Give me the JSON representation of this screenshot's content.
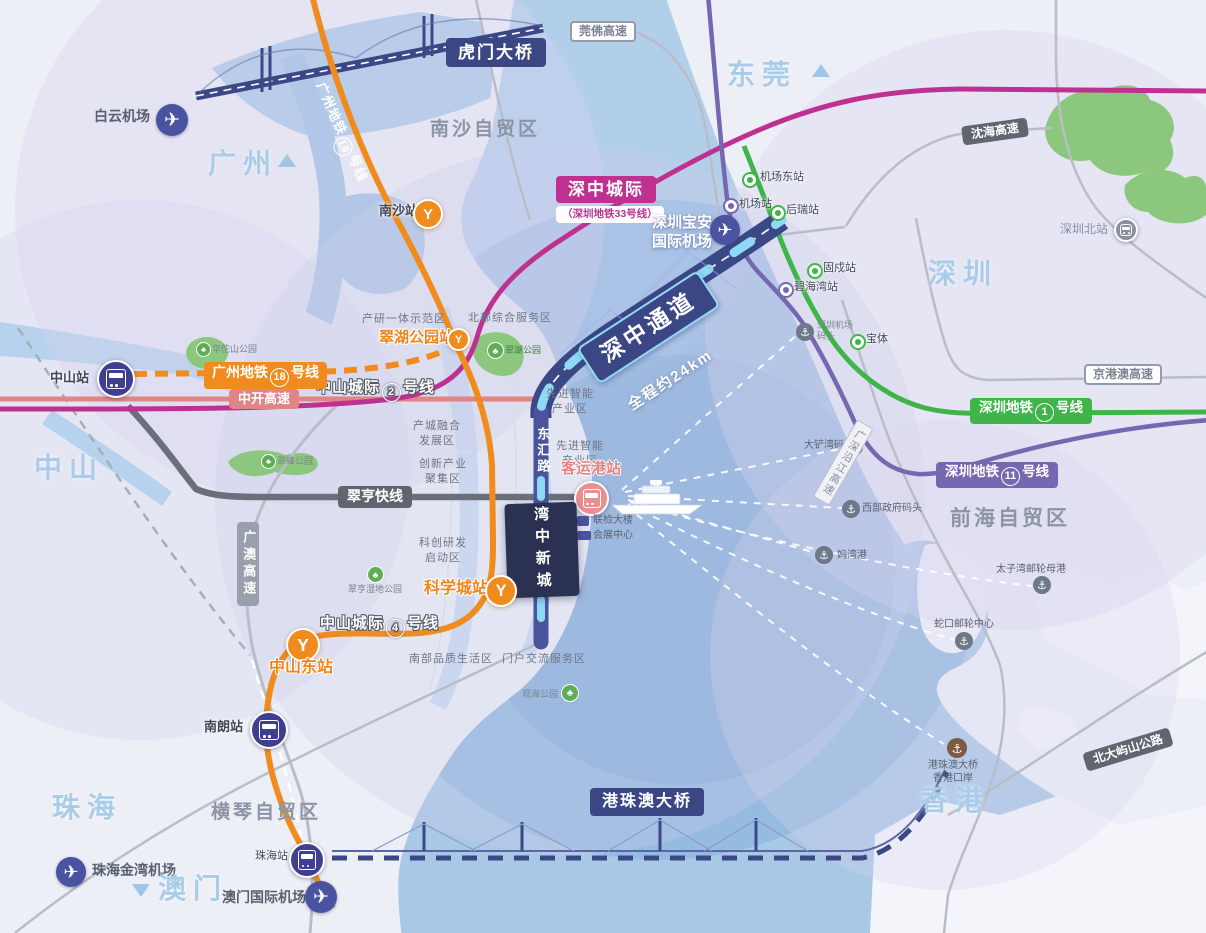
{
  "colors": {
    "orange": "#f08c1e",
    "magenta": "#bf3191",
    "navy": "#3a4784",
    "green": "#3fb44b",
    "purple": "#7668b0",
    "salmon": "#e08585",
    "coral": "#e89090",
    "dark_gray": "#60656f",
    "city_blue": "#a9cde9",
    "water": "#a9c8e6",
    "corridor_border": "#93d9f6",
    "park_green": "#8bc77d"
  },
  "cities": {
    "guangzhou": "广州",
    "dongguan": "东莞",
    "shenzhen": "深圳",
    "zhongshan": "中山",
    "zhuhai": "珠海",
    "macau": "澳门",
    "hongkong": "香港"
  },
  "zones": {
    "nansha": "南沙自贸区",
    "qianhai": "前海自贸区",
    "hengqin": "横琴自贸区"
  },
  "transit": {
    "gz18_prefix": "广州地铁",
    "gz18_num": "18",
    "gz18_suffix": "号线",
    "zs2_prefix": "中山城际",
    "zs2_num": "2",
    "zs2_suffix": "号线",
    "zs4_prefix": "中山城际",
    "zs4_num": "4",
    "zs4_suffix": "号线",
    "sz1_prefix": "深圳地铁",
    "sz1_num": "1",
    "sz1_suffix": "号线",
    "sz11_prefix": "深圳地铁",
    "sz11_num": "11",
    "sz11_suffix": "号线",
    "shenzhong_intercity": "深中城际",
    "shenzhong_intercity_sub": "（深圳地铁33号线）",
    "shenzhong_corridor": "深中通道",
    "corridor_length": "全程约24km",
    "cuiheng_express": "翠亨快线"
  },
  "roads": {
    "guanfo": "莞佛高速",
    "shenhai": "沈海高速",
    "zhongkai": "中开高速",
    "guangao": "广澳高速",
    "jinggangao": "京港澳高速",
    "yanjiang": "广深沿江高速",
    "north_lantau": "北大屿山公路",
    "donghui": "东汇路"
  },
  "bridges": {
    "humen": "虎门大桥",
    "hzmb": "港珠澳大桥"
  },
  "stations": {
    "nansha": "南沙站",
    "cuihu_park": "翠湖公园站",
    "zhongshan": "中山站",
    "science_city": "科学城站",
    "zhongshan_east": "中山东站",
    "nanlang": "南朗站",
    "zhuhai": "珠海站",
    "passenger_port": "客运港站",
    "shenzhen_north": "深圳北站",
    "airport_east": "机场东站",
    "airport": "机场站",
    "hourui": "后瑞站",
    "gushu": "固戍站",
    "bihaiwan": "碧海湾站",
    "baoti": "宝体"
  },
  "airports": {
    "baiyun": "白云机场",
    "szbaoan_line1": "深圳宝安",
    "szbaoan_line2": "国际机场",
    "zhuhai_jinwan": "珠海金湾机场",
    "macau_intl": "澳门国际机场"
  },
  "ports": {
    "shekou": "蛇口邮轮中心",
    "taiziwan": "太子湾邮轮母港",
    "mawan": "妈湾港",
    "west_gov": "西部政府码头",
    "dachanwan": "大铲湾码头",
    "sz_airport_pier_line1": "深圳机场",
    "sz_airport_pier_line2": "码头",
    "hzmb_hk_line1": "港珠澳大桥",
    "hzmb_hk_line2": "香港口岸"
  },
  "parks": {
    "cuihu": "翠湖公园",
    "huatuoshan": "华佗山公园",
    "cuifeng": "翠峰公园",
    "cuiheng_wetland": "翠亨湿地公园",
    "guanhai": "观海公园"
  },
  "districts": {
    "industry_research": "产研一体示范区",
    "north_service": "北部综合服务区",
    "adv_industry_line1": "先进智能",
    "adv_industry_line2": "产业区",
    "industry_city_line1": "产城融合",
    "industry_city_line2": "发展区",
    "innovation_line1": "创新产业",
    "innovation_line2": "聚集区",
    "scitech_line1": "科创研发",
    "scitech_line2": "启动区",
    "south_life": "南部品质生活区",
    "gateway": "门户交流服务区"
  },
  "landmarks": {
    "wanzhong": "湾中新城",
    "joint_inspection": "联检大楼",
    "convention_center": "会展中心"
  }
}
